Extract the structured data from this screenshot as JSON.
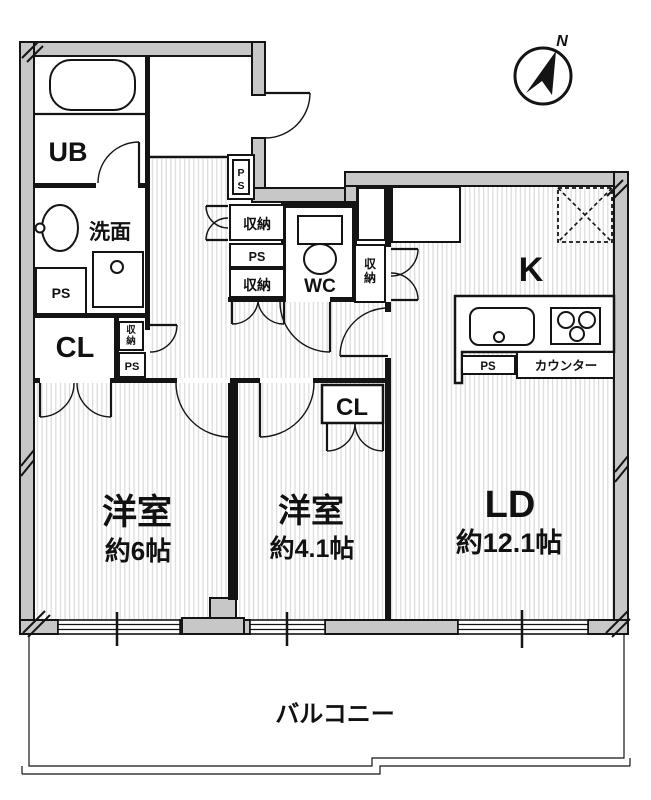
{
  "compass": {
    "north": "N"
  },
  "rooms": {
    "bath": {
      "label": "UB"
    },
    "washroom": {
      "label": "洗面"
    },
    "toilet": {
      "label": "WC"
    },
    "kitchen": {
      "label": "K"
    },
    "living_dining": {
      "label": "LD",
      "area": "約12.1帖"
    },
    "western_room_6": {
      "label": "洋室",
      "area": "約6帖"
    },
    "western_room_4_1": {
      "label": "洋室",
      "area": "約4.1帖"
    },
    "closet_west": {
      "label": "CL"
    },
    "closet_center": {
      "label": "CL"
    },
    "balcony": {
      "label": "バルコニー"
    }
  },
  "fixtures": {
    "counter_label": "カウンター",
    "ps_washroom": "PS",
    "ps_hall": "PS",
    "ps_corridor": "PS",
    "ps_kitchen": "PS",
    "ps_entry": [
      "P",
      "S"
    ],
    "storage_corridor_top": "収納",
    "storage_corridor_bottom": "収納",
    "storage_hall_mini": [
      "収",
      "納"
    ],
    "storage_east": [
      "収",
      "納"
    ]
  }
}
